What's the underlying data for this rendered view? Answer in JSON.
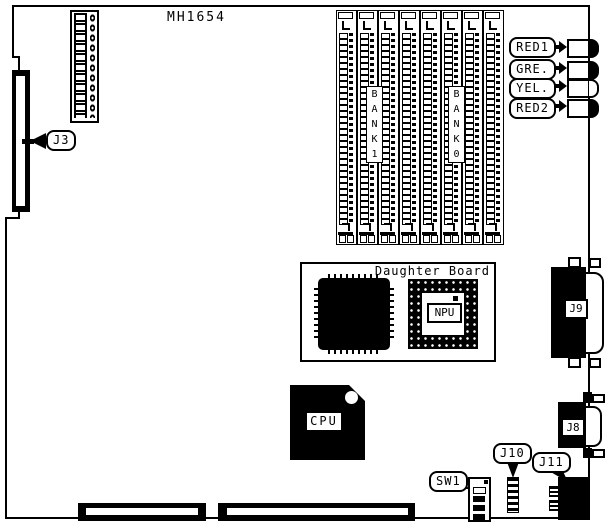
{
  "board": {
    "part_number": "MH1654",
    "memory_banks": {
      "bank1": "B\nA\nN\nK\n1",
      "bank0": "B\nA\nN\nK\n0"
    },
    "leds": [
      {
        "label": "RED1",
        "style": "filled"
      },
      {
        "label": "GRE.",
        "style": "filled"
      },
      {
        "label": "YEL.",
        "style": "outline"
      },
      {
        "label": "RED2",
        "style": "filled"
      }
    ],
    "callouts": {
      "j3": "J3",
      "sw1": "SW1",
      "j10": "J10",
      "j11": "J11"
    },
    "daughter_board": {
      "title": "Daughter Board",
      "npu": "NPU"
    },
    "chips": {
      "cpu": "CPU"
    },
    "connectors": {
      "j9": "J9",
      "j8": "J8"
    },
    "colors": {
      "line": "#000000",
      "background": "#ffffff",
      "component_fill": "#000000"
    }
  }
}
